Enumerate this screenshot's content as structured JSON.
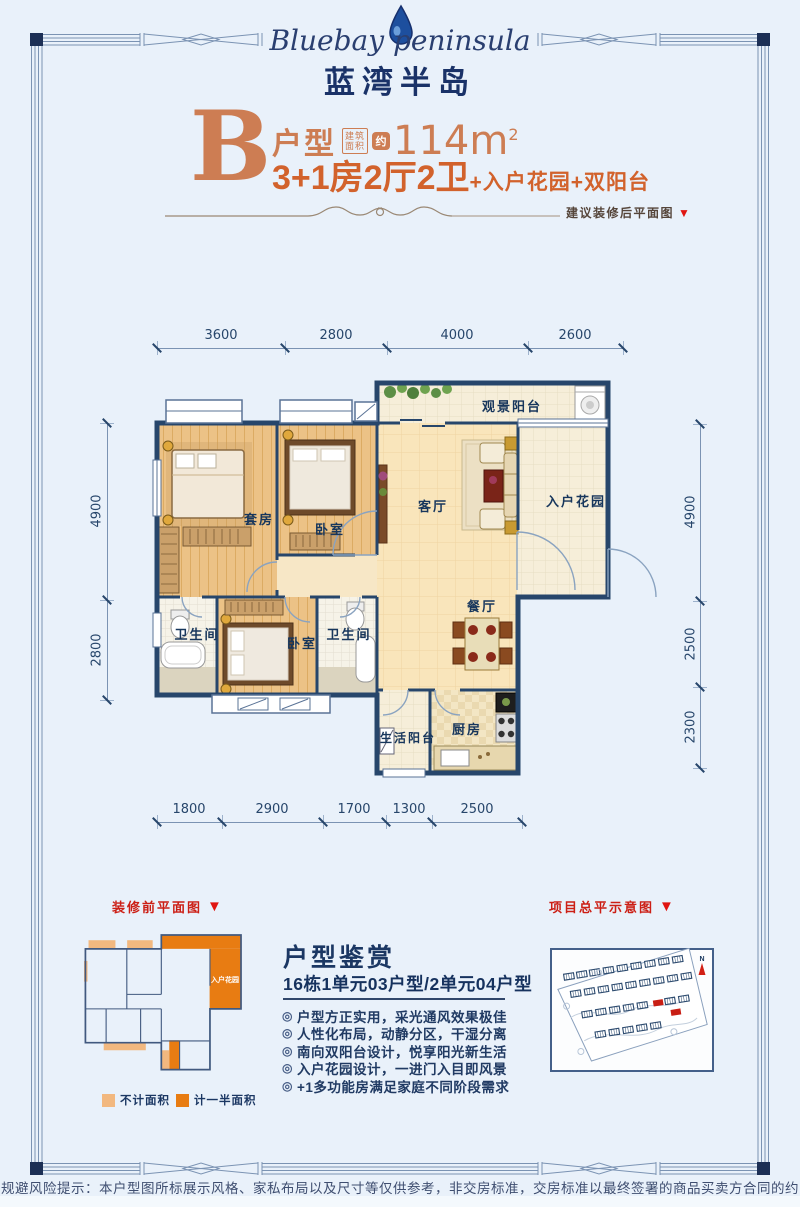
{
  "header": {
    "logo_en": "Bluebay peninsula",
    "logo_cn": "蓝湾半岛"
  },
  "title": {
    "letter": "B",
    "unit_label": "户型",
    "area_box": [
      "建筑",
      "面积"
    ],
    "approx": "约",
    "area_value": "114m",
    "area_sup": "2",
    "desc_main": "3+1房2厅2卫",
    "desc_plus": "+入户花园+双阳台",
    "after_reno_label": "建议装修后平面图"
  },
  "icons": {
    "triangle_down": "▼",
    "bullet": "◎",
    "compass_n": "N",
    "water_drop": "water-drop"
  },
  "plan": {
    "rooms": {
      "balcony_view": "观景阳台",
      "suite": "套房",
      "bedroom2": "卧室",
      "living": "客厅",
      "garden": "入户花园",
      "dining": "餐厅",
      "bath1": "卫生间",
      "bedroom3": "卧室",
      "bath2": "卫生间",
      "kitchen": "厨房",
      "balcony_life": "生活阳台"
    },
    "dims_top": [
      "3600",
      "2800",
      "4000",
      "2600"
    ],
    "dims_bottom": [
      "1800",
      "2900",
      "1700",
      "1300",
      "2500"
    ],
    "dims_left": [
      "4900",
      "2800"
    ],
    "dims_right": [
      "4900",
      "2500",
      "2300"
    ]
  },
  "before_reno": {
    "label": "装修前平面图",
    "garden_label": "入户花园",
    "legend": [
      {
        "label": "不计面积",
        "color": "#f2b87f"
      },
      {
        "label": "计一半面积",
        "color": "#e87c12"
      }
    ]
  },
  "appreciation": {
    "title": "户型鉴赏",
    "subtitle": "16栋1单元03户型/2单元04户型",
    "bullets": [
      "户型方正实用，采光通风效果极佳",
      "人性化布局，动静分区，干湿分离",
      "南向双阳台设计，悦享阳光新生活",
      "入户花园设计，一进门入目即风景",
      "+1多功能房满足家庭不同阶段需求"
    ]
  },
  "master_plan": {
    "label": "项目总平示意图"
  },
  "disclaimer": "规避风险提示：本户型图所标展示风格、家私布局以及尺寸等仅供参考，非交房标准，交房标准以最终签署的商品买卖方合同的约定为准",
  "colors": {
    "page_bg": "#e9f1fa",
    "accent_orange": "#cd7d53",
    "accent_orange_strong": "#d2622c",
    "navy": "#1b3763",
    "wall_navy": "#27466b",
    "red": "#d31f15",
    "legend_light": "#f2b87f",
    "legend_dark": "#e87c12"
  }
}
